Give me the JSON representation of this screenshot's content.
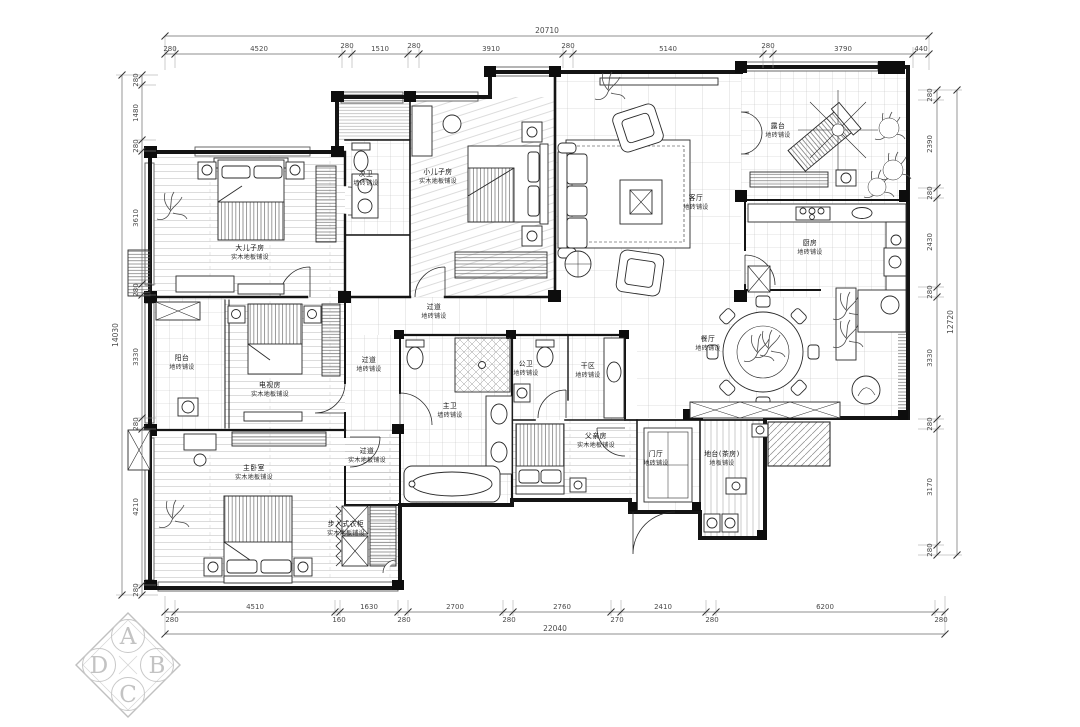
{
  "meta": {
    "drawing_bg": "#ffffff",
    "wall_color": "#141414",
    "dim_color": "#4a4a4a",
    "pattern_color": "#b5b5b5",
    "logo_color": "#c3c3c3"
  },
  "dimensions": {
    "top": {
      "total": "20710",
      "segments": [
        "280",
        "4520",
        "280",
        "1510",
        "280",
        "3910",
        "280",
        "5140",
        "280",
        "3790",
        "440"
      ]
    },
    "bottom": {
      "total": "22040",
      "segments": [
        "280",
        "4510",
        "160",
        "1630",
        "280",
        "2700",
        "280",
        "2760",
        "270",
        "2410",
        "280",
        "6200",
        "280"
      ]
    },
    "left": {
      "total": "14030",
      "segments": [
        "280",
        "1480",
        "280",
        "3610",
        "280",
        "3330",
        "280",
        "4210",
        "280"
      ]
    },
    "right": {
      "total": "12720",
      "segments": [
        "280",
        "2390",
        "280",
        "2430",
        "280",
        "3330",
        "280",
        "3170",
        "280"
      ]
    }
  },
  "rooms": [
    {
      "name": "大儿子房",
      "finish": "实木地板铺设"
    },
    {
      "name": "次卫",
      "finish": "墙砖铺设"
    },
    {
      "name": "小儿子房",
      "finish": "实木地板铺设"
    },
    {
      "name": "客厅",
      "finish": "地砖铺设"
    },
    {
      "name": "露台",
      "finish": "地砖铺设"
    },
    {
      "name": "厨房",
      "finish": "地砖铺设"
    },
    {
      "name": "餐厅",
      "finish": "地砖铺设"
    },
    {
      "name": "阳台",
      "finish": "地砖铺设"
    },
    {
      "name": "电视房",
      "finish": "实木地板铺设"
    },
    {
      "name": "过道",
      "finish": "地砖铺设"
    },
    {
      "name": "过道",
      "finish": "地砖铺设"
    },
    {
      "name": "主卫",
      "finish": "墙砖铺设"
    },
    {
      "name": "公卫",
      "finish": "地砖铺设"
    },
    {
      "name": "干区",
      "finish": "地砖铺设"
    },
    {
      "name": "父亲房",
      "finish": "实木地板铺设"
    },
    {
      "name": "门厅",
      "finish": "地砖铺设"
    },
    {
      "name": "地台(茶房)",
      "finish": "地板铺设"
    },
    {
      "name": "主卧室",
      "finish": "实木地板铺设"
    },
    {
      "name": "步入式衣柜",
      "finish": "实木地板铺设"
    },
    {
      "name": "过道",
      "finish": "实木地板铺设"
    }
  ],
  "logo": {
    "letters": [
      "A",
      "B",
      "C",
      "D"
    ]
  }
}
